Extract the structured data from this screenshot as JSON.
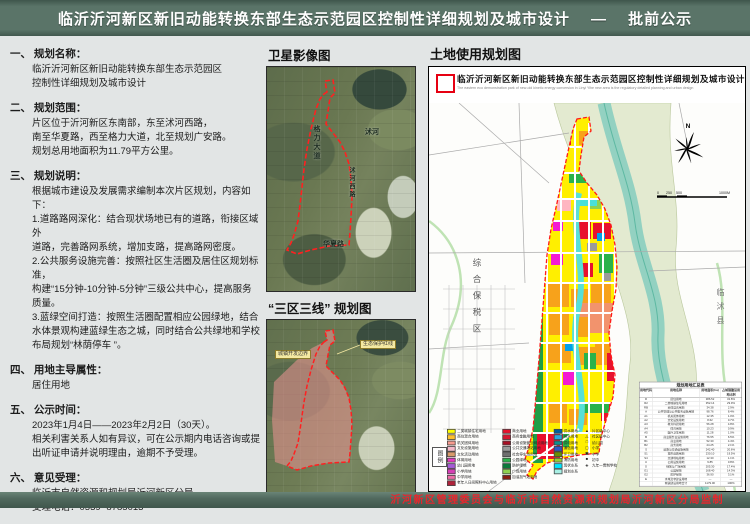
{
  "header": {
    "title": "临沂沂河新区新旧动能转换东部生态示范园区控制性详细规划及城市设计　 —　 批前公示"
  },
  "footer": {
    "credit": "沂河新区管理委员会与临沂市自然资源和规划局沂河新区分局监制"
  },
  "left_panel": {
    "sections": [
      {
        "h": "一、 规划名称：",
        "b": "临沂沂河新区新旧动能转换东部生态示范园区\n控制性详细规划及城市设计"
      },
      {
        "h": "二、 规划范围：",
        "b": "片区位于沂河新区东南部，东至沭河西路，\n南至华夏路，西至格力大道，北至规划广安路。\n规划总用地面积为11.79平方公里。"
      },
      {
        "h": "三、 规划说明：",
        "b": "根据城市建设及发展需求编制本次片区规划，内容如下：\n1.道路路网深化：结合现状场地已有的道路，衔接区域外\n道路，完善路网系统，增加支路，提高路网密度。\n2.公共服务设施完善：按照社区生活圈及居住区规划标准，\n构建“15分钟-10分钟-5分钟”三级公共中心，提高服务\n质量。\n3.蓝绿空间打造：按照生活圈配置相应公园绿地，结合\n水体景观构建蓝绿生态之城，同时结合公共绿地和学校\n布局规划“林荫停车 ”。"
      },
      {
        "h": "四、 用地主导属性：",
        "b": "居住用地"
      },
      {
        "h": "五、 公示时间：",
        "b": "2023年1月4日——2023年2月2日（30天）。\n相关利害关系人如有异议，可在公示期内电话咨询或提\n出听证申请并说明理由，逾期不予受理。"
      },
      {
        "h": "六、 意见受理：",
        "b": "临沂市自然资源和规划局沂河新区分局\n受理电话：0539- 8785013"
      }
    ]
  },
  "middle": {
    "satellite_title": "卫星影像图",
    "three_zones_title": "“三区三线” 规划图",
    "sat_labels": {
      "west_road": "格力大道",
      "river": "沭河",
      "south_road": "华夏路",
      "east_road": "沭河西路"
    },
    "zone_labels": {
      "boundary": "城镇开发边界",
      "redline": "生态保护红线"
    }
  },
  "map_panel": {
    "title": "土地使用规划图",
    "inner_title": "临沂沂河新区新旧动能转换东部生态示范园区控制性详细规划及城市设计",
    "inner_subtitle_en": "The eastern eco demonstration park of new-old kinetic energy conversion in Linyi Yihe new area is the regulatory detailed planning and urban design",
    "compass": "N",
    "scale_text": "0  250  500            1000M",
    "place_labels": {
      "bonded_zone": "综合保税区",
      "linshu_county": "临沭县"
    },
    "legend": {
      "title": "图例",
      "col1": [
        {
          "color": "#ffff00",
          "label": "二类城镇住宅用地"
        },
        {
          "color": "#fdbf2d",
          "label": "商住混合用地"
        },
        {
          "color": "#f79a8e",
          "label": "机关团体用地"
        },
        {
          "color": "#f4b8c8",
          "label": "文化设施用地"
        },
        {
          "color": "#d89a6a",
          "label": "文化活动用地"
        },
        {
          "color": "#e838c2",
          "label": "体育用地"
        },
        {
          "color": "#a55bd6",
          "label": "幼儿园用地"
        },
        {
          "color": "#d63fb4",
          "label": "小学用地"
        },
        {
          "color": "#f06ba8",
          "label": "中学用地"
        },
        {
          "color": "#b0233a",
          "label": "老年人日间照料中心用地"
        }
      ],
      "col2": [
        {
          "color": "#e8112d",
          "label": "商业用地"
        },
        {
          "color": "#d61630",
          "label": "商务金融用地"
        },
        {
          "color": "#a80f24",
          "label": "公用设施营业网点用地"
        },
        {
          "color": "#9b9b9b",
          "label": "公共交通场站用地"
        },
        {
          "color": "#6f6f6f",
          "label": "社会停车场用地"
        },
        {
          "color": "#2ab24a",
          "label": "公园绿地"
        },
        {
          "color": "#0b7a3a",
          "label": "防护绿地"
        },
        {
          "color": "#8fd14f",
          "label": "广场用地"
        },
        {
          "color": "#8a1c10",
          "label": "加油加气站用地"
        }
      ],
      "col3": [
        {
          "color": "#005f9e",
          "label": "供水用地"
        },
        {
          "color": "#2aa7df",
          "label": "排水用地"
        },
        {
          "color": "#0d8f8f",
          "label": "供电用地"
        },
        {
          "color": "#2f55c4",
          "label": "通信用地"
        },
        {
          "color": "#6a8f00",
          "label": "环卫用地"
        },
        {
          "color": "#9acd32",
          "label": "消防用地"
        },
        {
          "color": "#00e5ff",
          "label": "现状水系"
        },
        {
          "color": "#a8f0e4",
          "label": "规划水系"
        }
      ],
      "col4": [
        {
          "sym": "▲",
          "label": "片区级中心"
        },
        {
          "sym": "△",
          "label": "社区级中心"
        },
        {
          "sym": "□",
          "label": "幼儿园"
        },
        {
          "sym": "▢",
          "label": "小学"
        },
        {
          "sym": "▣",
          "label": "中学"
        },
        {
          "sym": "■",
          "label": "初中"
        },
        {
          "sym": "◈",
          "label": "九年一贯制学校"
        }
      ]
    },
    "table": {
      "title": "规划用地汇总表",
      "headers": [
        "用地代码",
        "用地名称",
        "用地面积(ha)",
        "占城镇建设用地比例"
      ],
      "rows": [
        {
          "c": "R",
          "n": "居住用地",
          "a": "386.52",
          "p": "32.8%"
        },
        {
          "c": "R2",
          "n": "二类城镇住宅用地",
          "a": "352.14",
          "p": "29.9%"
        },
        {
          "c": "RB",
          "n": "商住混合用地",
          "a": "34.38",
          "p": "2.9%"
        },
        {
          "c": "A",
          "n": "公共管理与公共服务设施用地",
          "a": "98.76",
          "p": "8.4%"
        },
        {
          "c": "A1",
          "n": "机关团体用地",
          "a": "12.35",
          "p": "1.0%"
        },
        {
          "c": "A2",
          "n": "文化设施用地",
          "a": "8.62",
          "p": "0.7%"
        },
        {
          "c": "A3",
          "n": "教育科研用地",
          "a": "56.28",
          "p": "4.8%"
        },
        {
          "c": "A4",
          "n": "体育用地",
          "a": "10.23",
          "p": "0.9%"
        },
        {
          "c": "A5",
          "n": "医疗卫生用地",
          "a": "11.28",
          "p": "1.0%"
        },
        {
          "c": "B",
          "n": "商业服务业设施用地",
          "a": "76.55",
          "p": "6.5%"
        },
        {
          "c": "B1",
          "n": "商业用地",
          "a": "52.30",
          "p": "4.4%"
        },
        {
          "c": "B2",
          "n": "商务用地",
          "a": "24.25",
          "p": "2.1%"
        },
        {
          "c": "S",
          "n": "道路与交通设施用地",
          "a": "242.40",
          "p": "20.6%"
        },
        {
          "c": "S1",
          "n": "城市道路用地",
          "a": "230.10",
          "p": "19.5%"
        },
        {
          "c": "S4",
          "n": "交通场站用地",
          "a": "12.30",
          "p": "1.1%"
        },
        {
          "c": "U",
          "n": "公用设施用地",
          "a": "9.85",
          "p": "0.8%"
        },
        {
          "c": "G",
          "n": "绿地与广场用地",
          "a": "205.30",
          "p": "17.4%"
        },
        {
          "c": "G1",
          "n": "公园绿地",
          "a": "168.40",
          "p": "14.3%"
        },
        {
          "c": "G2",
          "n": "防护绿地",
          "a": "36.90",
          "p": "3.1%"
        },
        {
          "c": "E",
          "n": "水域及非建设用地",
          "a": "—",
          "p": "—"
        },
        {
          "c": "",
          "n": "城镇建设用地合计",
          "a": "1179.00",
          "p": "100%"
        }
      ]
    }
  }
}
